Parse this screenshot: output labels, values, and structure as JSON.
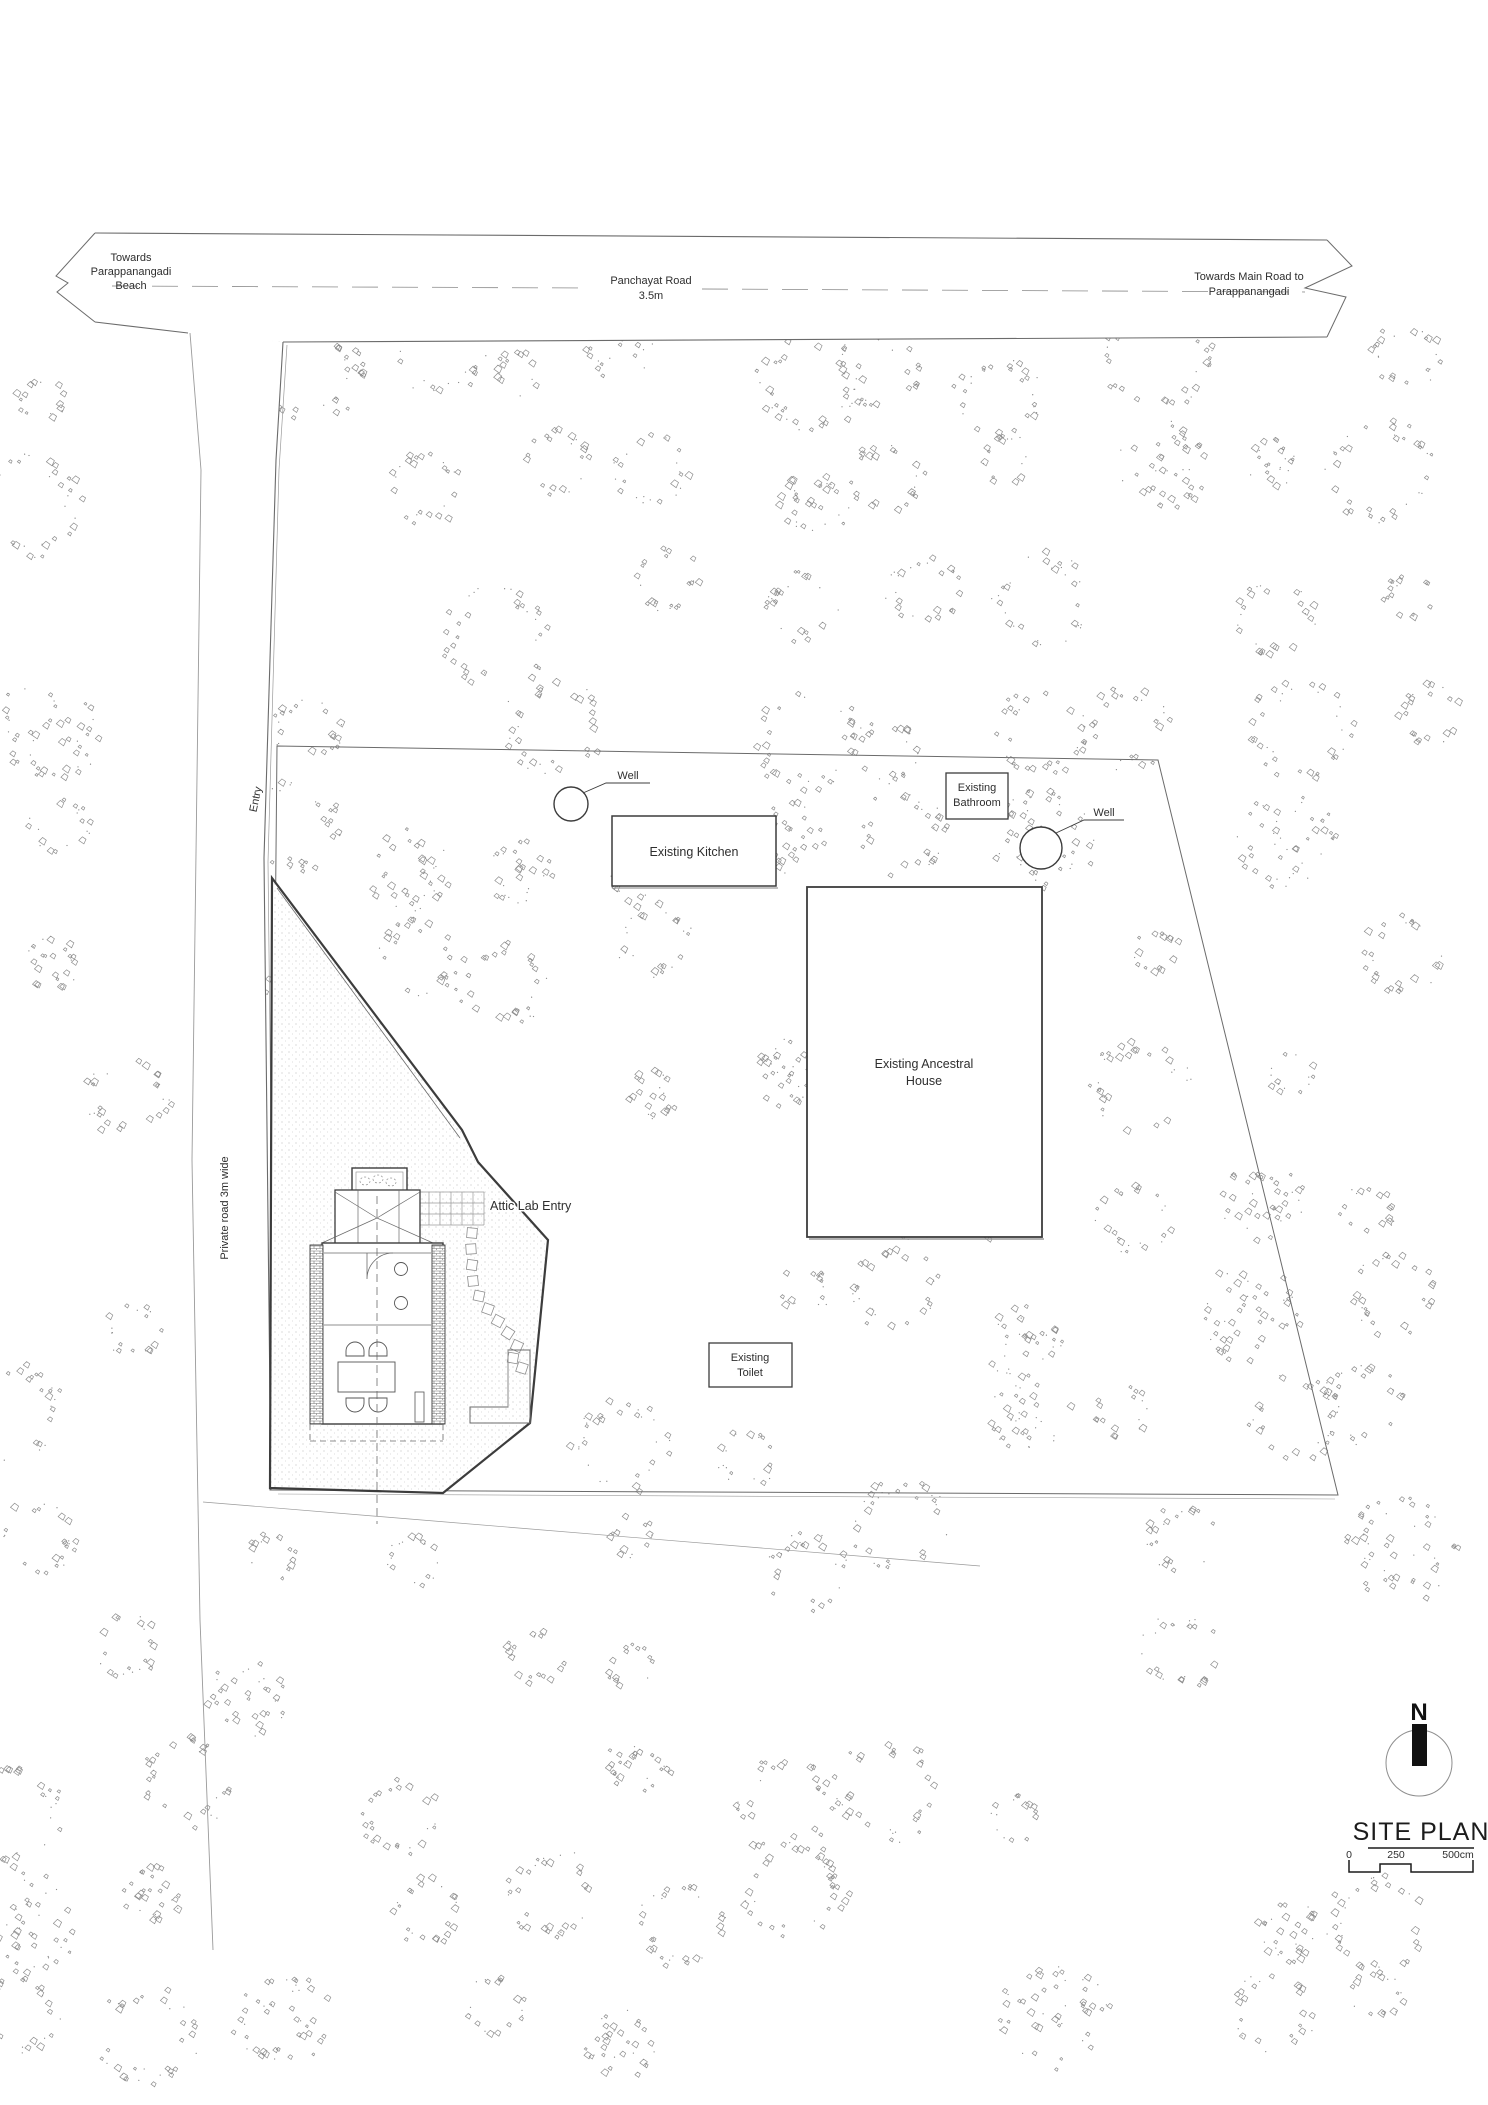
{
  "drawing": {
    "title": "SITE PLAN",
    "north_label": "N"
  },
  "roads": {
    "panchayat": {
      "name": "Panchayat Road",
      "width_label": "3.5m"
    },
    "towards_beach": {
      "line1": "Towards",
      "line2": "Parappanangadi",
      "line3": "Beach"
    },
    "towards_main_road": {
      "line1": "Towards Main Road to",
      "line2": "Parappanangadi"
    },
    "private_road_label": "Private road 3m wide",
    "entry_label": "Entry"
  },
  "structures": {
    "kitchen_label": "Existing Kitchen",
    "bathroom": {
      "line1": "Existing",
      "line2": "Bathroom"
    },
    "ancestral_house": {
      "line1": "Existing Ancestral",
      "line2": "House"
    },
    "toilet": {
      "line1": "Existing",
      "line2": "Toilet"
    },
    "attic_lab_entry_label": "Attic Lab Entry",
    "well_label_left": "Well",
    "well_label_right": "Well"
  },
  "scale_bar": {
    "start": "0",
    "middle": "250",
    "end": "500cm"
  },
  "colors": {
    "ink": "#3c3c3c",
    "tree": "#8e8e8e",
    "light_line": "#9a9a9a"
  }
}
